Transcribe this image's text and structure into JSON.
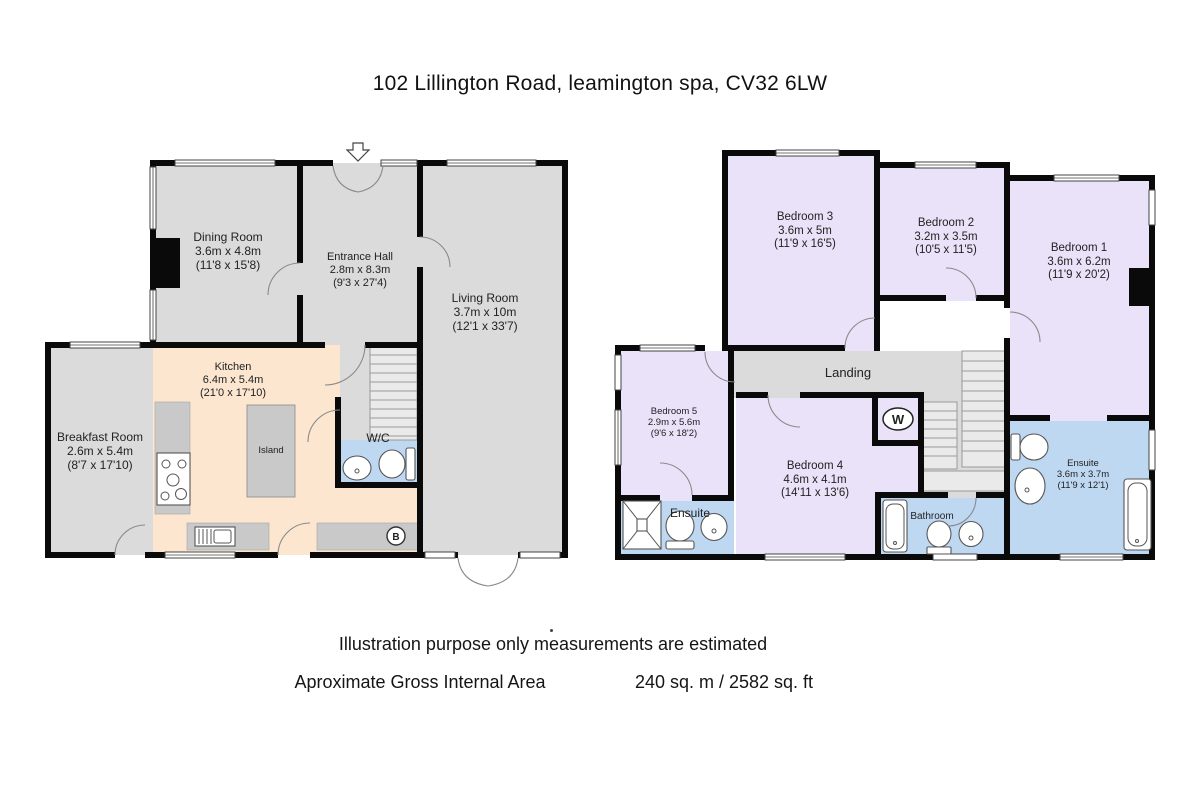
{
  "title": "102 Lillington Road, leamington spa, CV32 6LW",
  "footer": {
    "line1": "Illustration purpose only measurements are estimated",
    "line2_label": "Aproximate Gross Internal Area",
    "line2_value": "240 sq. m  / 2582 sq. ft"
  },
  "ground_floor": {
    "rooms": {
      "dining": {
        "name": "Dining Room",
        "metric": "3.6m x 4.8m",
        "imperial": "(11'8 x 15'8)"
      },
      "entrance": {
        "name": "Entrance Hall",
        "metric": "2.8m x 8.3m",
        "imperial": "(9'3 x 27'4)"
      },
      "living": {
        "name": "Living Room",
        "metric": "3.7m x 10m",
        "imperial": "(12'1 x 33'7)"
      },
      "kitchen": {
        "name": "Kitchen",
        "metric": "6.4m x 5.4m",
        "imperial": "(21'0 x 17'10)"
      },
      "breakfast": {
        "name": "Breakfast Room",
        "metric": "2.6m x 5.4m",
        "imperial": "(8'7 x 17'10)"
      },
      "wc": {
        "name": "W/C"
      },
      "island": {
        "name": "Island"
      }
    },
    "icons": {
      "boiler": "B"
    }
  },
  "first_floor": {
    "rooms": {
      "bedroom1": {
        "name": "Bedroom 1",
        "metric": "3.6m x 6.2m",
        "imperial": "(11'9 x 20'2)"
      },
      "bedroom2": {
        "name": "Bedroom 2",
        "metric": "3.2m x 3.5m",
        "imperial": "(10'5 x 11'5)"
      },
      "bedroom3": {
        "name": "Bedroom 3",
        "metric": "3.6m x 5m",
        "imperial": "(11'9 x 16'5)"
      },
      "bedroom4": {
        "name": "Bedroom 4",
        "metric": "4.6m x 4.1m",
        "imperial": "(14'11 x 13'6)"
      },
      "bedroom5": {
        "name": "Bedroom 5",
        "metric": "2.9m x 5.6m",
        "imperial": "(9'6 x 18'2)"
      },
      "landing": {
        "name": "Landing"
      },
      "ensuite_left": {
        "name": "Ensuite"
      },
      "bathroom": {
        "name": "Bathroom"
      },
      "ensuite_right": {
        "name": "Ensuite",
        "metric": "3.6m x 3.7m",
        "imperial": "(11'9 x 12'1)"
      }
    },
    "icons": {
      "washer": "W"
    }
  },
  "colors": {
    "wall": "#0a0a0a",
    "room_gray": "#DBDBDB",
    "bedroom_lavender": "#EAE2F8",
    "wet_room_blue": "#BFD8F2",
    "kitchen_peach": "#FCE6CF",
    "counter_gray": "#C9C9C9"
  }
}
